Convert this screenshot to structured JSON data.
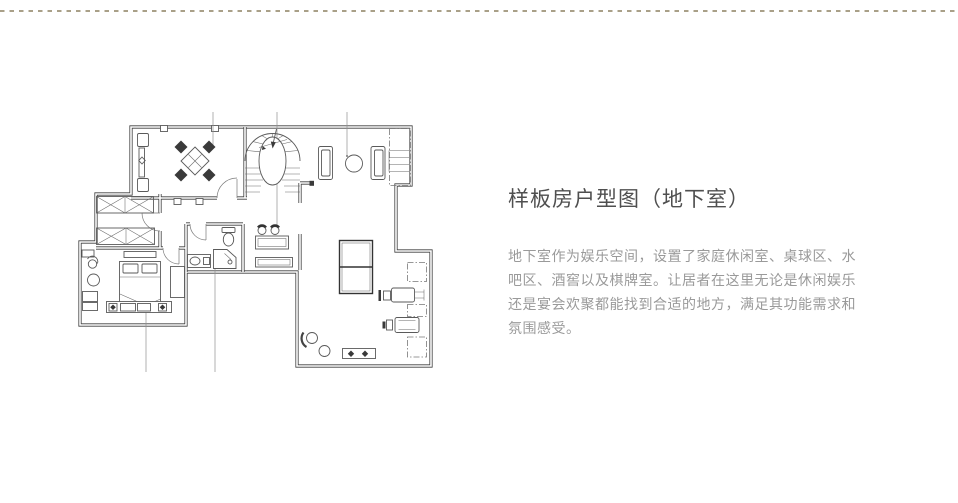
{
  "page": {
    "title": "样板房户型图（地下室）",
    "description": "地下室作为娱乐空间，设置了家庭休闲室、桌球区、水吧区、酒窖以及棋牌室。让居者在这里无论是休闲娱乐还是宴会欢聚都能找到合适的地方，满足其功能需求和氛围感受。",
    "colors": {
      "divider": "#a9a088",
      "title_text": "#4f4f4f",
      "body_text": "#9a9a9a",
      "plan_line": "#3f3f3f"
    }
  }
}
